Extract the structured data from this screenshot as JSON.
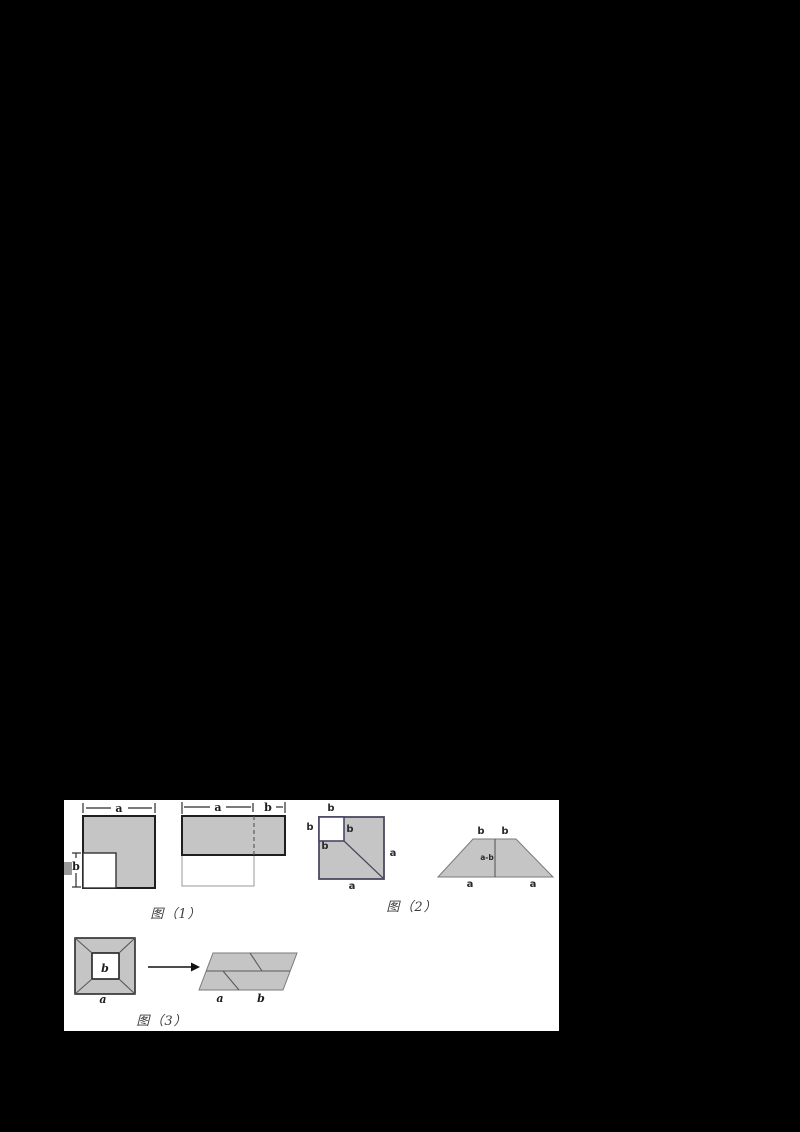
{
  "colors": {
    "shape_fill": "#c5c5c5",
    "white_fill": "#ffffff",
    "artifact_gray": "#9a9a9a",
    "page_bg": "#000000"
  },
  "figure1": {
    "caption": "图（1）",
    "left_square": {
      "dim_top": "a",
      "dim_side": "b"
    },
    "right_rect": {
      "dim_top_a": "a",
      "dim_top_b": "b"
    }
  },
  "figure2": {
    "caption": "图（2）",
    "square": {
      "label_top": "b",
      "label_left": "b",
      "label_right": "b",
      "label_inner": "b",
      "label_side": "a",
      "label_bottom": "a"
    },
    "trapezoid": {
      "label_top_left": "b",
      "label_top_right": "b",
      "label_middle": "a-b",
      "label_bottom_left": "a",
      "label_bottom_right": "a"
    }
  },
  "figure3": {
    "caption": "图（3）",
    "frame": {
      "label_inner": "b",
      "label_bottom": "a"
    },
    "parallelogram": {
      "label_a": "a",
      "label_b": "b"
    }
  }
}
